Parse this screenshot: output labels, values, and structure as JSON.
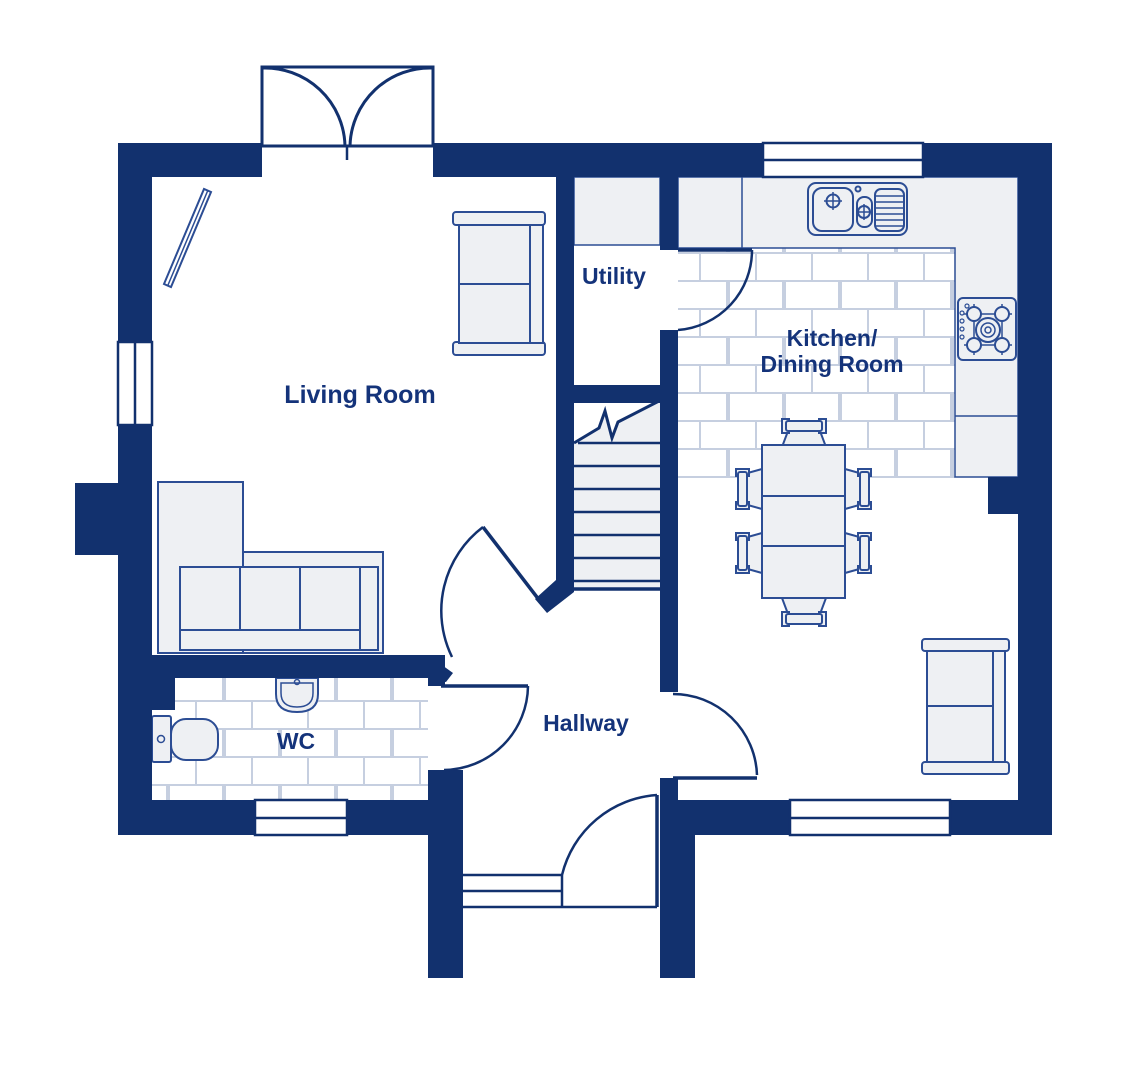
{
  "floorplan": {
    "rooms": {
      "living_room": {
        "label": "Living Room"
      },
      "utility": {
        "label": "Utility"
      },
      "kitchen_dining": {
        "label_line1": "Kitchen/",
        "label_line2": "Dining Room"
      },
      "wc": {
        "label": "WC"
      },
      "hallway": {
        "label": "Hallway"
      }
    },
    "fixtures": {
      "sink": "double-sink-with-drainer",
      "hob": "gas-hob-5-burner",
      "toilet": "toilet",
      "basin": "hand-basin",
      "sofa_corner": "l-shaped-sofa",
      "sofa_small_living": "two-seat-sofa",
      "sofa_small_dining": "two-seat-sofa",
      "tv": "wall-mounted-tv",
      "dining_table": "table-with-six-chairs",
      "stairs": "staircase-up"
    },
    "colors": {
      "wall": "#12316e",
      "label_text": "#14337a",
      "furniture_stroke": "#2c4d94",
      "furniture_fill": "#eef0f3",
      "tile_line": "#c6cfe0",
      "background": "#ffffff"
    }
  }
}
